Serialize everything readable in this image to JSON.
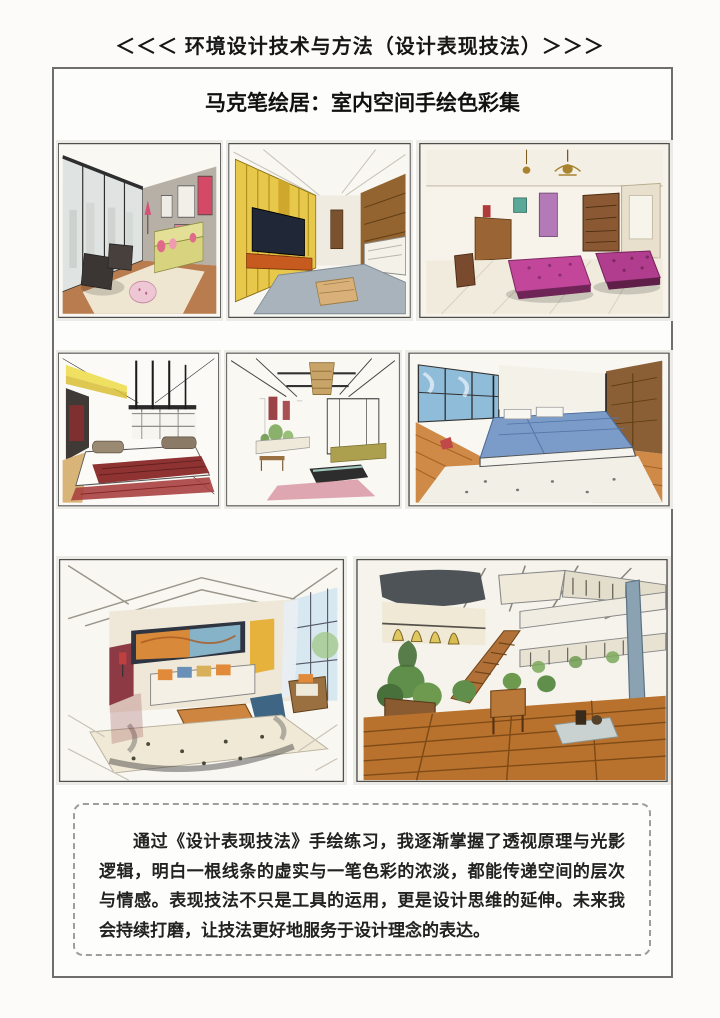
{
  "header": {
    "title": "＜＜＜ 环境设计技术与方法（设计表现技法）＞＞＞"
  },
  "album": {
    "title": "马克笔绘居：室内空间手绘色彩集",
    "sketches": [
      {
        "id": "living-room-city-window",
        "description": "客厅手绘：落地窗、黄色沙发与深色单椅",
        "palette": [
          "#dfe3e2",
          "#b7b0a6",
          "#d8d37f",
          "#e06a8a",
          "#3b3533",
          "#b97c4e"
        ]
      },
      {
        "id": "tv-wall-living-room",
        "description": "客厅手绘：金色电视墙与灰蓝地毯",
        "palette": [
          "#e7c84b",
          "#202837",
          "#c75a1e",
          "#a9b3bc",
          "#93642f",
          "#f4f1e9"
        ]
      },
      {
        "id": "magenta-ottoman-lounge",
        "description": "起居室手绘：玫红软榻与吊灯书柜",
        "palette": [
          "#c2479a",
          "#b03d8e",
          "#a9832e",
          "#8a5832",
          "#b47ab8",
          "#f1ebdd"
        ]
      },
      {
        "id": "platform-bed-room",
        "description": "卧室手绘：黄色灯片与暗红铺面平台床",
        "palette": [
          "#f0e062",
          "#8e3232",
          "#a84040",
          "#1c1c1c",
          "#d9b478",
          "#fbfaf6"
        ]
      },
      {
        "id": "coffered-ceiling-lounge",
        "description": "客厅手绘：格栅吊顶、木质吊灯与绿植",
        "palette": [
          "#c9a468",
          "#9a4448",
          "#7ca85c",
          "#aca04e",
          "#d898a4",
          "#2d2d2d"
        ]
      },
      {
        "id": "blue-bedding-bedroom",
        "description": "卧室手绘：蓝色床品与木地板",
        "palette": [
          "#8fbcd9",
          "#7b9bc8",
          "#d08a48",
          "#8a5f36",
          "#f2efe6",
          "#c04848"
        ]
      },
      {
        "id": "two-point-living-room",
        "description": "客厅手绘：两点透视、长幅挂画与木茶几",
        "palette": [
          "#d88a3a",
          "#87b3c9",
          "#e6b23c",
          "#8e3a44",
          "#cd8540",
          "#3f6585"
        ]
      },
      {
        "id": "loft-atrium",
        "description": "复式中庭手绘：楼梯、绿植与木质地台",
        "palette": [
          "#4e5358",
          "#e0c860",
          "#b07038",
          "#5f8f4a",
          "#b9712e",
          "#8aa2b2"
        ]
      }
    ]
  },
  "quote": {
    "text": "通过《设计表现技法》手绘练习，我逐渐掌握了透视原理与光影逻辑，明白一根线条的虚实与一笔色彩的浓淡，都能传递空间的层次与情感。表现技法不只是工具的运用，更是设计思维的延伸。未来我会持续打磨，让技法更好地服务于设计理念的表达。"
  },
  "colors": {
    "page_background": "#fcfbf9",
    "outer_border": "#6e6e6e",
    "dashed_border": "#9e9e9e",
    "title_text": "#161616",
    "body_text": "#222222"
  }
}
